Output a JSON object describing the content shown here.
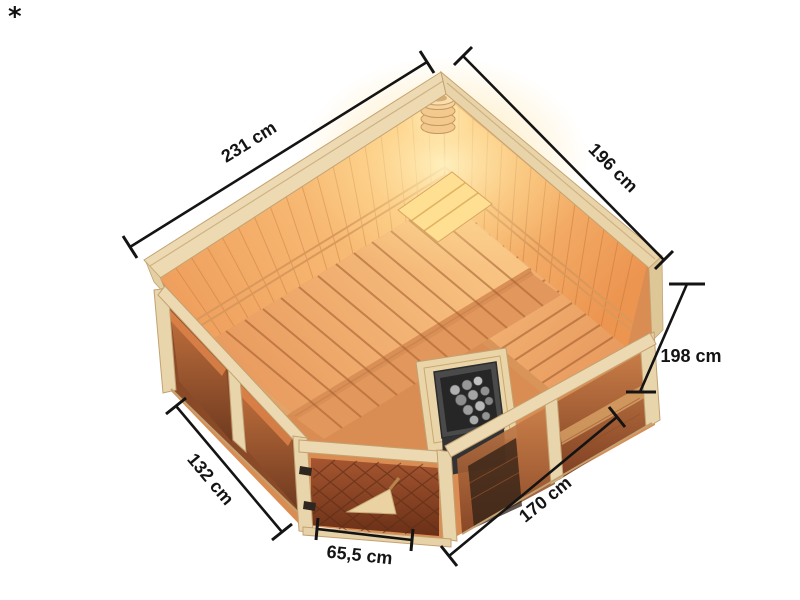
{
  "page": {
    "background": "#ffffff",
    "footnote_marker": "*"
  },
  "illustration": {
    "description": "Isometric cutaway top view of a corner sauna with glass front, corner entry door, slatted benches, heater and corner vent",
    "wood_color": "#ecd9b1",
    "interior_glow_color": "#ffd48a",
    "bench_color": "#f0a96e",
    "glass_color": "#b96b3f",
    "heater_color": "#454545",
    "dimension_line_color": "#141414"
  },
  "dimensions": {
    "back_left_wall": "231 cm",
    "back_right_wall": "196 cm",
    "height": "198 cm",
    "front_left_wall": "132 cm",
    "front_right_wall": "170 cm",
    "door_width": "65,5 cm"
  }
}
